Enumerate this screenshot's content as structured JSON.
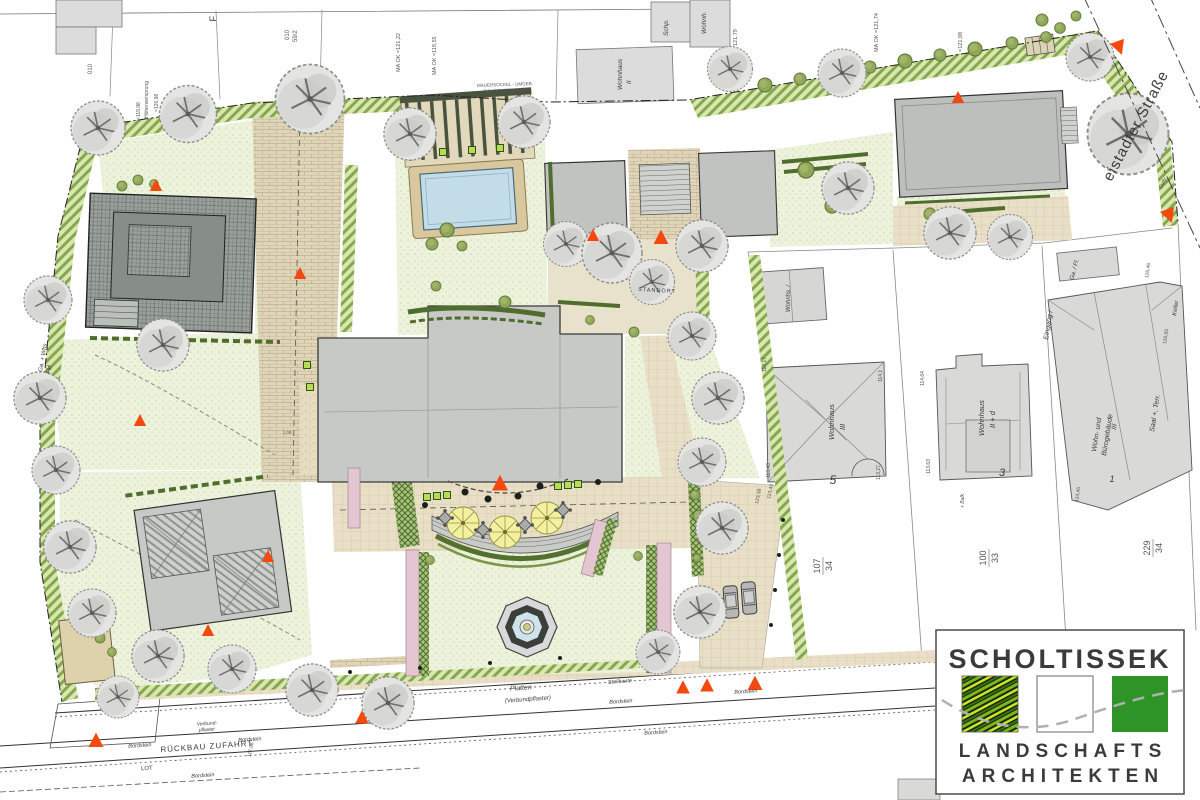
{
  "labels": {
    "street": "eistadter Straße",
    "gully": "Gully",
    "rueckbau": "RÜCKBAU ZUFAHRT",
    "bordstein": "Bordstein",
    "platten": "Platten",
    "verbundpflaster": "(Verbundpflaster)",
    "steilkante": "Steilkante",
    "verbund": "Verbund-",
    "pflaster": "pflaster",
    "lot": "LOT",
    "elev_11296": "112,96",
    "standort": "STANDORT",
    "ma_12122": "MA OK =121,22",
    "ma_11955": "MA OK =119,55",
    "ma_12174": "MA OK =121,74",
    "ma_12198": "=121,98",
    "mauersockel1": "MAUERSOCKEL - UMGEB.",
    "mauersockel2": "ZUM SCHORNSTEIN",
    "hoehenversprung": "Höhenversprung",
    "hv1": "=119,98",
    "hv2": "=120,98",
    "ga_whs": "Ga. + Whs",
    "fld": "Fld",
    "f": "F",
    "p010": "010",
    "p592": "59/2",
    "elev_12179": "121,79",
    "dim100": "1,00",
    "elev_11343b": "113,43",
    "elev_12339": "123,39"
  },
  "neighbors": {
    "wh2_l1": "Wohnhaus",
    "wh2_l2": "II",
    "schp": "Schp.",
    "wohnh": "Wohnh.",
    "whs_small": "Wohnhs. /",
    "w3": {
      "l1": "Wohnhaus",
      "l2": "III",
      "num": "5",
      "e1": "113,43",
      "e2": "113,27",
      "e3": "114,1",
      "e4": "114,17"
    },
    "w2d": {
      "l1": "Wohnhaus",
      "l2": "II + d",
      "num": "3",
      "e1": "114,64",
      "e2": "113,63",
      "balk": "+ Balk."
    },
    "buero": {
      "l1": "Wohn- und",
      "l2": "Bürogebäude",
      "l3": "III",
      "eingang": "Eingang /",
      "saal": "Saal +, Terr.",
      "keller": "Keller",
      "num": "1",
      "e1": "116,65",
      "e2": "116,46",
      "e3": "114,45"
    },
    "gafl": "Ga. / Fl.",
    "parcels": {
      "p1a": "107",
      "p1b": "34",
      "p2a": "100",
      "p2b": "33",
      "p3a": "229",
      "p3b": "34"
    }
  },
  "logo": {
    "title": "SCHOLTISSEK",
    "line1": "LANDSCHAFTS",
    "line2": "ARCHITEKTEN"
  },
  "colors": {
    "accent_orange": "#f3490f",
    "logo_green": "#2f9e2f",
    "logo_gray": "#a6a6a6",
    "pool_blue": "#c2dde8",
    "lawn_green": "#edf2dc",
    "hatch_green": "#84a84b",
    "hedge_green": "#4f6d2c",
    "building_gray": "#c6c9c5",
    "paving_tan": "#e8dfc6",
    "pink_bed": "#e3c6d2"
  }
}
